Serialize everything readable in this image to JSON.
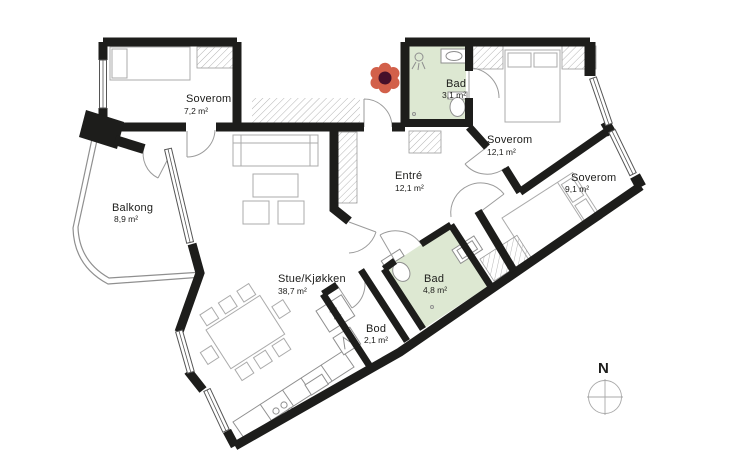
{
  "rooms": [
    {
      "id": "soverom-1",
      "name": "Soverom",
      "area": "7,2 m²"
    },
    {
      "id": "bad-1",
      "name": "Bad",
      "area": "3,1 m²"
    },
    {
      "id": "soverom-2",
      "name": "Soverom",
      "area": "12,1 m²"
    },
    {
      "id": "soverom-3",
      "name": "Soverom",
      "area": "9,1 m²"
    },
    {
      "id": "entre",
      "name": "Entré",
      "area": "12,1 m²"
    },
    {
      "id": "balkong",
      "name": "Balkong",
      "area": "8,9 m²"
    },
    {
      "id": "stue",
      "name": "Stue/Kjøkken",
      "area": "38,7 m²"
    },
    {
      "id": "bad-2",
      "name": "Bad",
      "area": "4,8 m²"
    },
    {
      "id": "bod",
      "name": "Bod",
      "area": "2,1 m²"
    }
  ],
  "compass": {
    "north_label": "N"
  },
  "colors": {
    "wall": "#1d1d1b",
    "bathroom_fill": "#dde8d2",
    "flower_petal": "#d2604a",
    "flower_center": "#45102a",
    "thin_line": "#ababab"
  }
}
